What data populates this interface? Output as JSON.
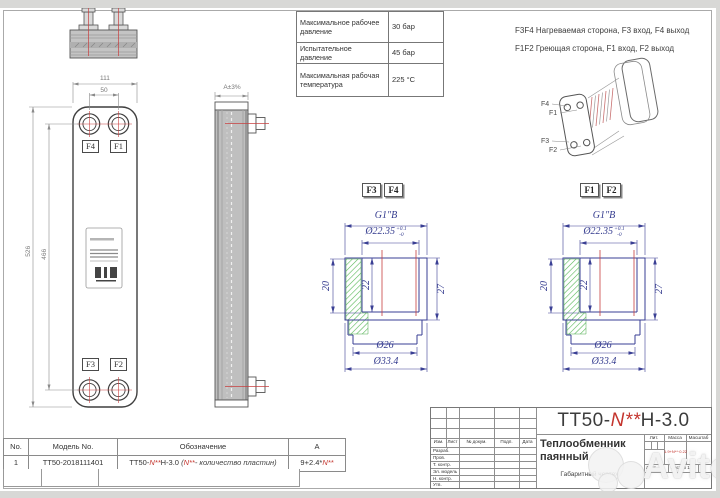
{
  "spec_table": {
    "rows": [
      {
        "label": "Максимальное рабочее давление",
        "value": "30 бар"
      },
      {
        "label": "Испытательное давление",
        "value": "45 бар"
      },
      {
        "label": "Максимальная рабочая температура",
        "value": "225 °C"
      }
    ]
  },
  "notes": {
    "line1": "F3F4 Нагреваемая сторона, F3 вход, F4 выход",
    "line2": "F1F2 Греющая сторона, F1 вход, F2 выход"
  },
  "front_view": {
    "dim_width": "111",
    "dim_port_spacing": "50",
    "dim_height": "526",
    "dim_port_height": "466",
    "labels": {
      "top_left": "F4",
      "top_right": "F1",
      "bottom_left": "F3",
      "bottom_right": "F2"
    }
  },
  "side_view": {
    "dim": "A±3%"
  },
  "iso_view": {
    "labels": [
      "F4",
      "F1",
      "F3",
      "F2"
    ]
  },
  "detail_left": {
    "tag1": "F3",
    "tag2": "F4",
    "thread": "G1\"B",
    "bore": "Ø22.35",
    "tol_plus": "+0.1",
    "tol_minus": "-0",
    "depth_outer": "20",
    "depth_inner": "22",
    "height": "27",
    "dia_small": "Ø26",
    "dia_large": "Ø33.4"
  },
  "detail_right": {
    "tag1": "F1",
    "tag2": "F2",
    "thread": "G1\"B",
    "bore": "Ø22.35",
    "tol_plus": "+0.1",
    "tol_minus": "-0",
    "depth_outer": "20",
    "depth_inner": "22",
    "height": "27",
    "dia_small": "Ø26",
    "dia_large": "Ø33.4"
  },
  "model_table": {
    "headers": [
      "No.",
      "Модель No.",
      "Обозначение",
      "A"
    ],
    "row": {
      "no": "1",
      "model": "TT50-2018111401",
      "des_prefix": "TT50-",
      "des_n": "N**",
      "des_suffix": "H-3.0",
      "note_pre": "(",
      "note_n": "N**",
      "note_text": "- количество пластин)",
      "a_prefix": "9+2.4*",
      "a_n": "N**"
    }
  },
  "title_block": {
    "code_prefix": "TT50-",
    "code_n": "N**",
    "code_suffix": "H-3.0",
    "product_name": "Теплообменник паянный",
    "doc_type": "Габаритный чертеж",
    "cols": [
      "Изм.",
      "Лист",
      "№ докум.",
      "Подп.",
      "Дата"
    ],
    "rows": [
      "Разраб.",
      "Пров.",
      "Т. контр.",
      "Эл. модель",
      "Н. контр.",
      "Утв."
    ],
    "lit": "Лит.",
    "mass": "Масса",
    "scale": "Масштаб",
    "mass_value": "1.9+N**·0.22",
    "sheet": "Лист",
    "sheets": "Листов 1"
  },
  "watermark": {
    "text": "Avito"
  }
}
